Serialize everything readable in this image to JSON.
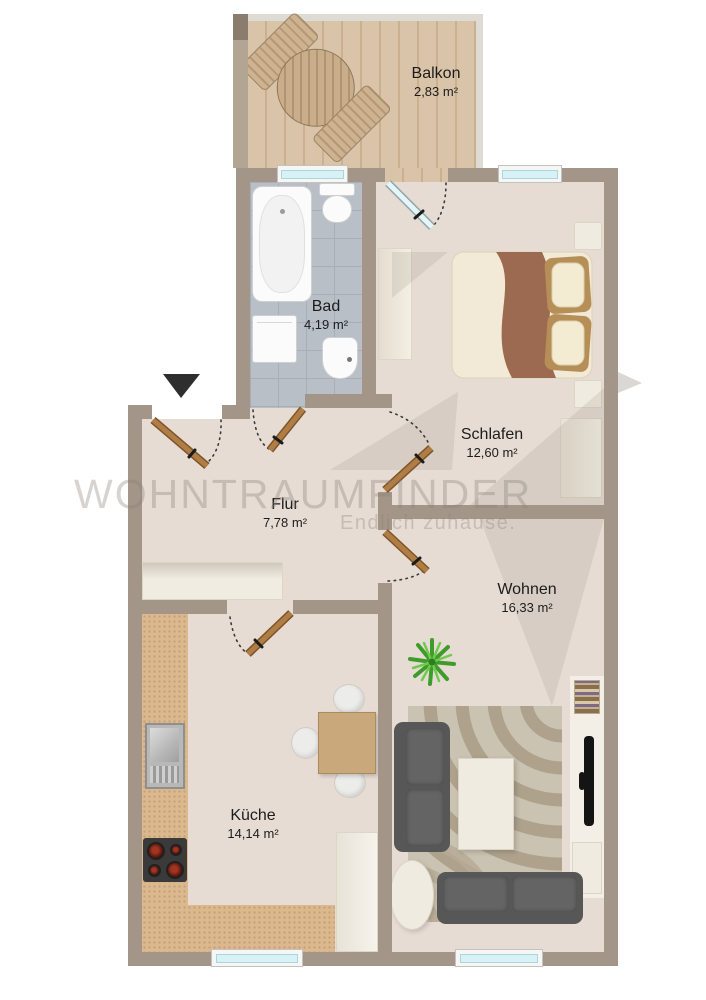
{
  "watermark": {
    "brand": "WOHNTRAUMFINDER",
    "tagline": "Endlich zuhause."
  },
  "rooms": [
    {
      "name": "Balkon",
      "area": "2,83 m²"
    },
    {
      "name": "Bad",
      "area": "4,19 m²"
    },
    {
      "name": "Schlafen",
      "area": "12,60 m²"
    },
    {
      "name": "Flur",
      "area": "7,78 m²"
    },
    {
      "name": "Wohnen",
      "area": "16,33 m²"
    },
    {
      "name": "Küche",
      "area": "14,14 m²"
    }
  ],
  "palette": {
    "wall": "#a39688",
    "floor": "#e7dcd4",
    "balcony_wood": "#d6c1a4",
    "bath_tile": "#b9bfc7",
    "kitchen_counter": "#dcb88e",
    "door_leaf": "#aa7743",
    "window_glass": "#d7f2f6",
    "sofa": "#575757",
    "bed_blanket": "#9c6a50"
  }
}
